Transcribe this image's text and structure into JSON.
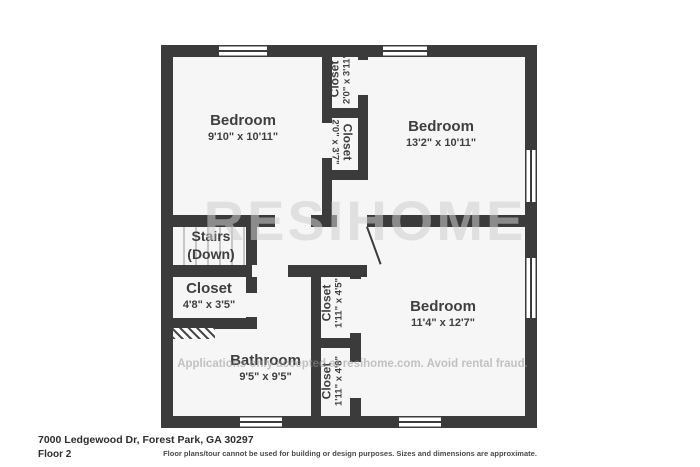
{
  "plan": {
    "watermark_large": "RESIHOME",
    "watermark_small": "Applications only accepted at resihome.com. Avoid rental fraud.",
    "rooms": {
      "bedroom1": {
        "name": "Bedroom",
        "dims": "9'10\" x 10'11\""
      },
      "closet_top1": {
        "name": "Closet",
        "dims": "2'0\" x 3'11\""
      },
      "closet_top2": {
        "name": "Closet",
        "dims": "2'0\" x 3'7\""
      },
      "bedroom2": {
        "name": "Bedroom",
        "dims": "13'2\" x 10'11\""
      },
      "stairs": {
        "name": "Stairs",
        "dims": "(Down)"
      },
      "closet_left": {
        "name": "Closet",
        "dims": "4'8\" x 3'5\""
      },
      "closet_mid": {
        "name": "Closet",
        "dims": "1'11\" x 4'5\""
      },
      "bathroom": {
        "name": "Bathroom",
        "dims": "9'5\" x 9'5\""
      },
      "closet_bottom": {
        "name": "Closet",
        "dims": "1'11\" x 4'8\""
      },
      "bedroom3": {
        "name": "Bedroom",
        "dims": "11'4\" x 12'7\""
      }
    }
  },
  "footer": {
    "address": "7000 Ledgewood Dr, Forest Park, GA 30297",
    "floor_label": "Floor 2",
    "disclaimer": "Floor plans/tour cannot be used for building or design purposes. Sizes and dimensions are approximate."
  },
  "colors": {
    "wall": "#3b3b3b",
    "room_fill": "#f6f6f6",
    "label_text": "#3f3f3f",
    "watermark": "#cdcdcd"
  }
}
